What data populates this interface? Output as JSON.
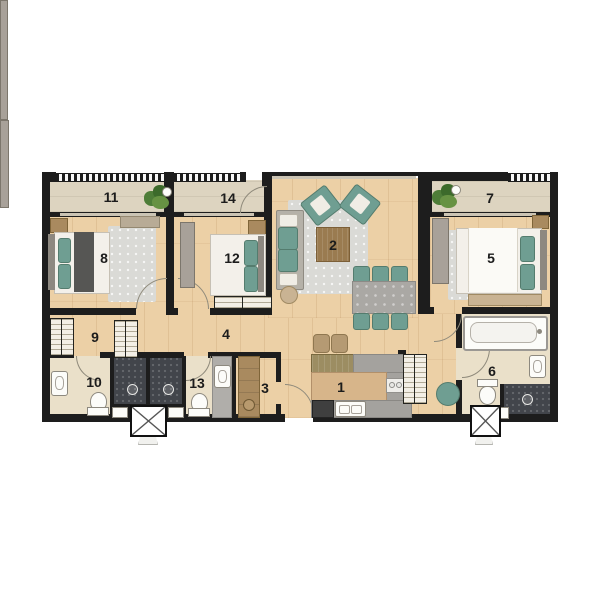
{
  "plan": {
    "rooms": [
      {
        "label": "1"
      },
      {
        "label": "2"
      },
      {
        "label": "3"
      },
      {
        "label": "4"
      },
      {
        "label": "5"
      },
      {
        "label": "6"
      },
      {
        "label": "7"
      },
      {
        "label": "8"
      },
      {
        "label": "9"
      },
      {
        "label": "10"
      },
      {
        "label": "11"
      },
      {
        "label": "12"
      },
      {
        "label": "13"
      },
      {
        "label": "14"
      }
    ],
    "colors": {
      "wall": "#1d1d1d",
      "wood_floor": "#ecd0a6",
      "balcony_floor": "#ddd4c0",
      "bathroom_floor": "#eae0c9",
      "shower_floor": "#42454b",
      "accent_teal": "#6f9e92",
      "counter_gray": "#a4a29e",
      "furniture_wood": "#a98a5f",
      "rug_gray": "#dadad6",
      "plant_green": "#4e7d38"
    }
  }
}
